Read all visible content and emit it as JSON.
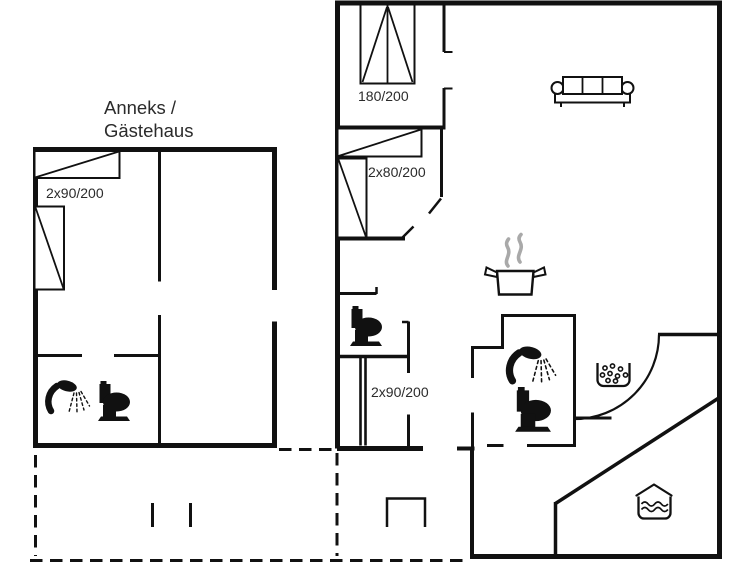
{
  "plan": {
    "annex": {
      "title_line1": "Anneks /",
      "title_line2": "Gästehaus",
      "bed_label": "2x90/200"
    },
    "main": {
      "double_bed_label": "180/200",
      "bunk_bed_label": "2x80/200",
      "hall_bunk_bed_label": "2x90/200"
    },
    "icons": {
      "annex_bathroom": [
        "shower-icon",
        "toilet-icon"
      ],
      "main_wc": [
        "toilet-icon"
      ],
      "main_bathroom": [
        "shower-icon",
        "toilet-icon"
      ],
      "kitchen": [
        "cooking-pot-steam-icon"
      ],
      "living_room": [
        "sofa-icon"
      ],
      "hall": [
        "whirlpool-icon"
      ],
      "conservatory": [
        "hot-tub-icon"
      ]
    },
    "colors": {
      "wall": "#111111",
      "steam": "#a9a9a9",
      "text": "#2b2b2b",
      "background": "#ffffff"
    }
  }
}
